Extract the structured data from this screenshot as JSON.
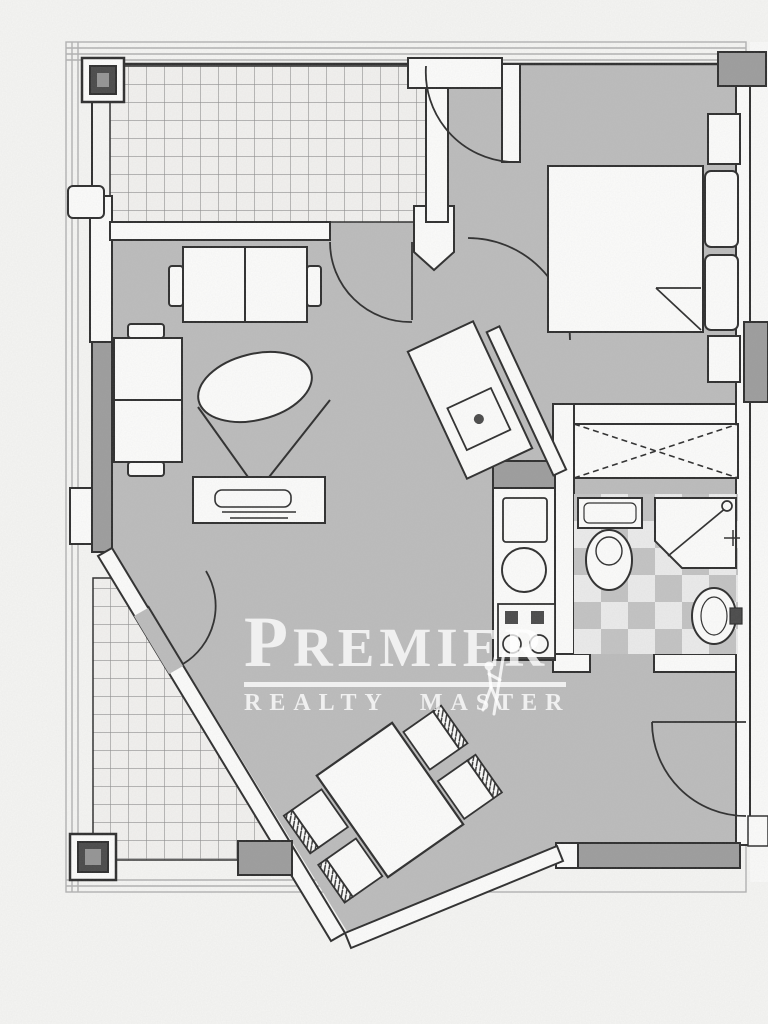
{
  "watermark": {
    "initial": "P",
    "rest": "REMIER",
    "subtitle_left": "REALTY",
    "subtitle_right": "MASTER"
  },
  "colors": {
    "bg": "#f5f5f3",
    "floor": "#bcbcbc",
    "wall": "#fcfcfb",
    "ink": "#2e2e2e",
    "pier": "#9d9d9d",
    "column": "#4a4a4a",
    "tile_bg": "#f2f1ef",
    "tile_line": "#8f8f8f",
    "checker_light": "#ebebeb",
    "checker_dark": "#c3c3c3",
    "faint": "#b2b2b2",
    "margin_white": "#fafaf9",
    "watermark": "rgba(255,255,255,0.78)"
  },
  "plan": {
    "type": "apartment-floor-plan",
    "rooms": [
      "terrace-top",
      "terrace-bottom",
      "living-room",
      "hall",
      "bedroom",
      "bathroom",
      "kitchen",
      "dining-area"
    ],
    "furniture_icons": [
      "two-seat-sofa-icon",
      "loveseat-icon",
      "oval-coffee-table-icon",
      "tv-stand-icon",
      "double-bed-icon",
      "pillow-icon",
      "nightstand-icon",
      "wardrobe-x-icon",
      "dining-table-icon",
      "dining-chair-icon",
      "kitchen-sink-icon",
      "stove-burners-icon",
      "counter-sink-icon",
      "toilet-icon",
      "shower-cabin-icon",
      "washbasin-icon",
      "door-arc-icon",
      "column-icon"
    ]
  }
}
